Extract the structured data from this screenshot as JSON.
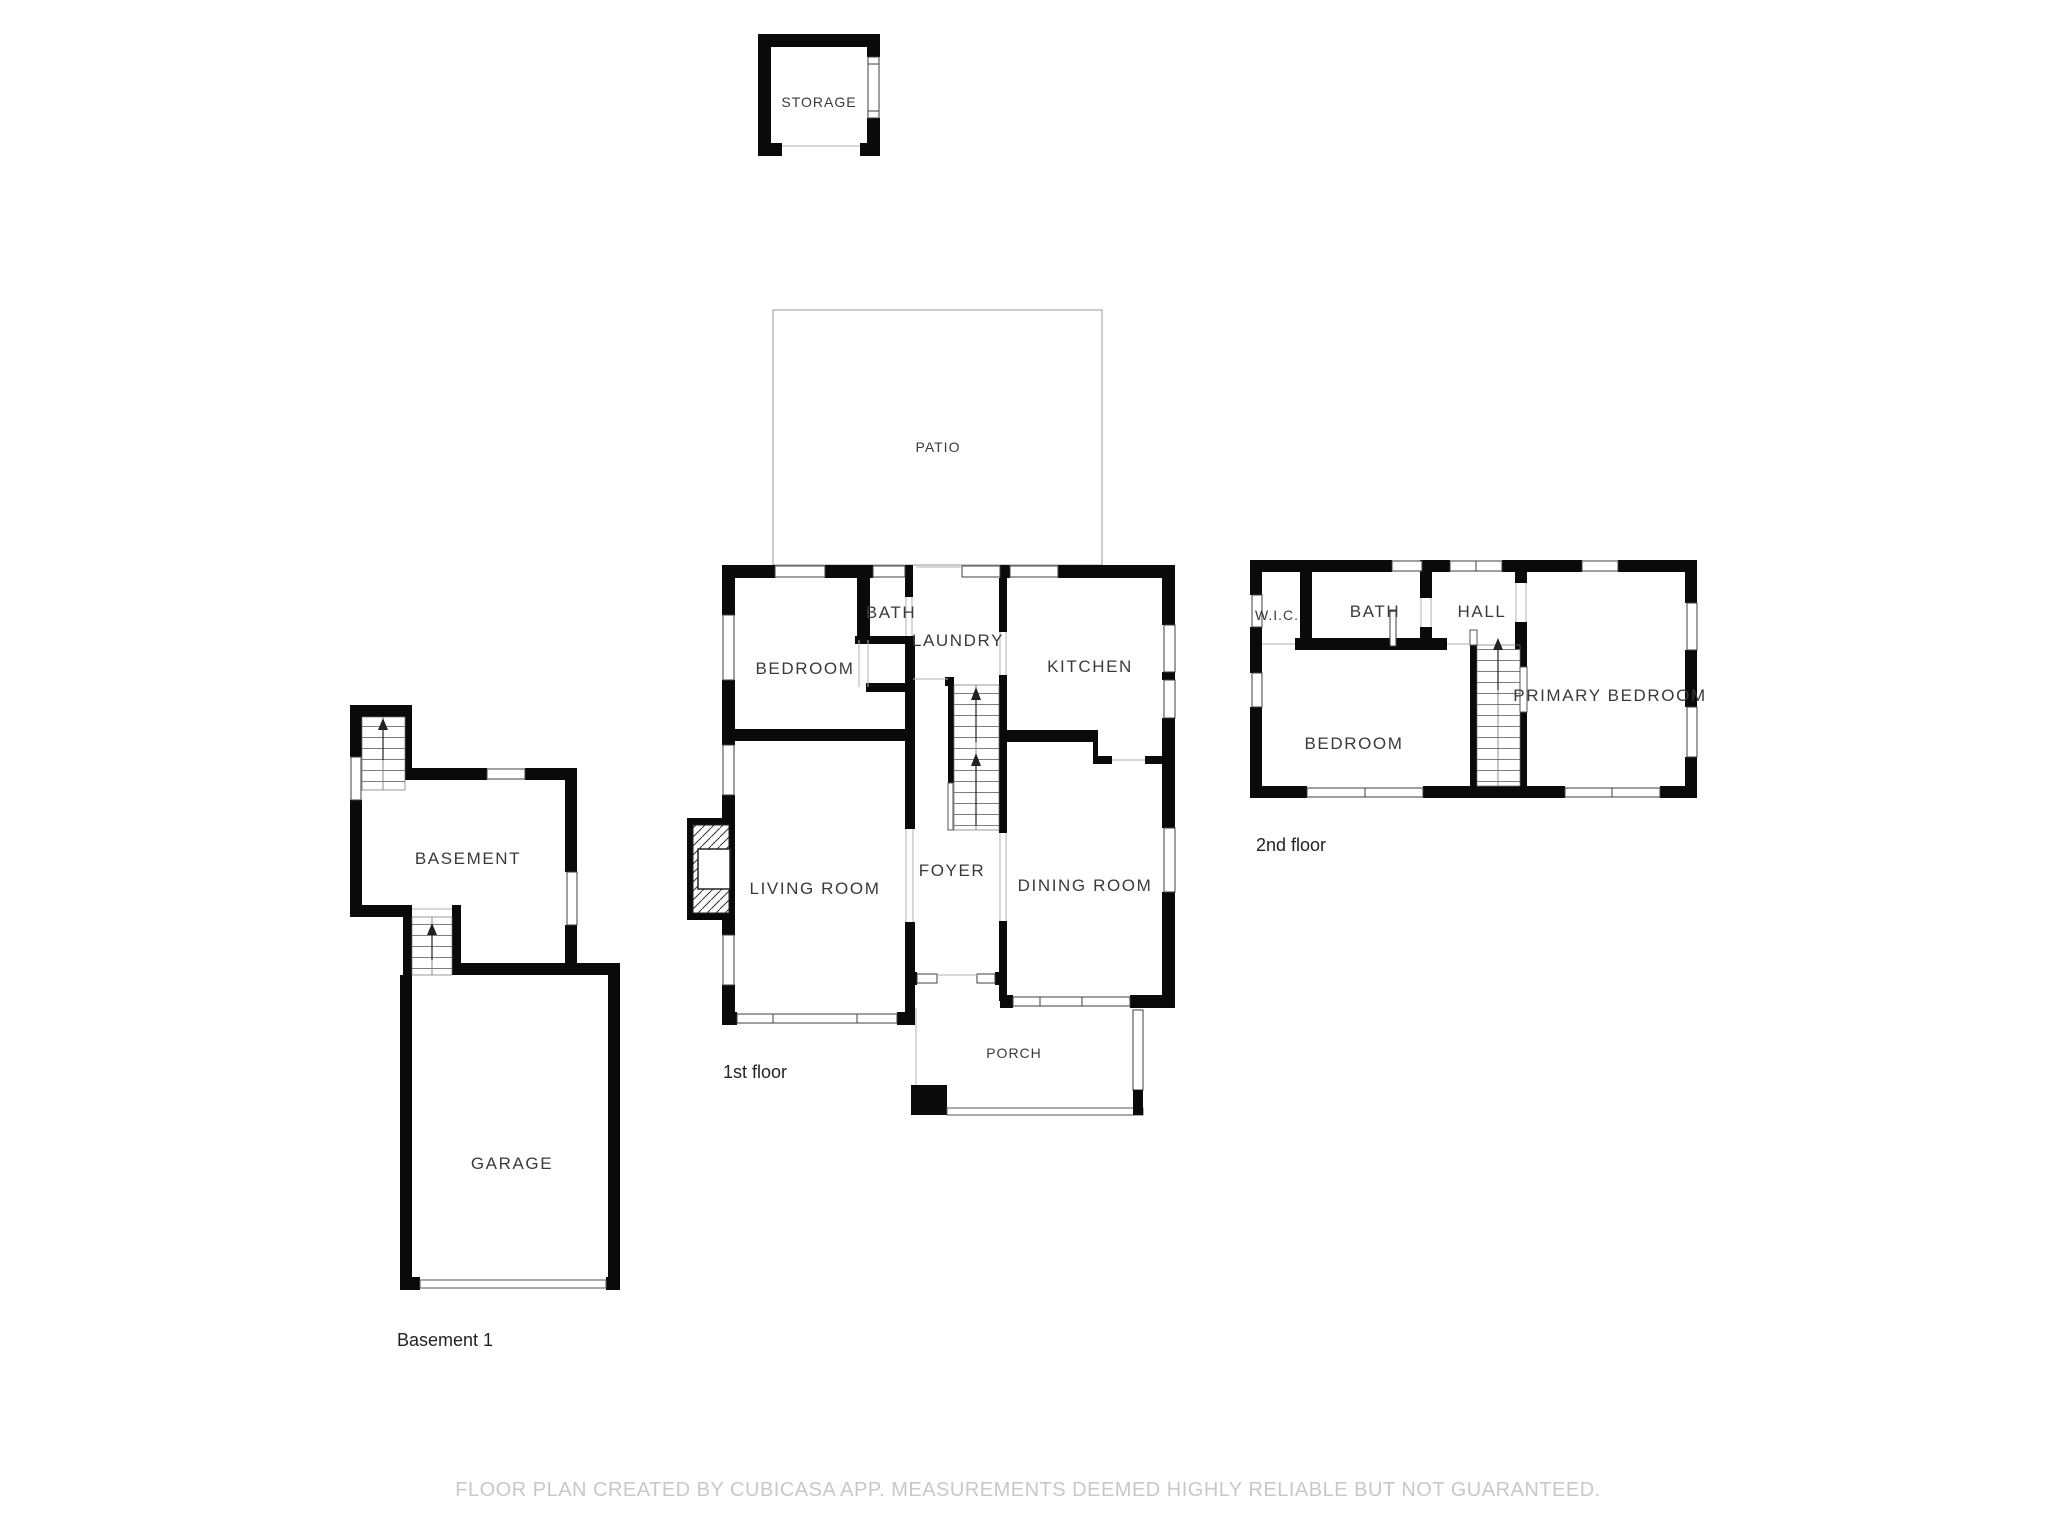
{
  "floors": {
    "storage": {
      "label": "STORAGE"
    },
    "patio": {
      "label": "PATIO"
    },
    "first": {
      "name": "1st floor",
      "rooms": {
        "bedroom": "BEDROOM",
        "bath": "BATH",
        "laundry": "LAUNDRY",
        "kitchen": "KITCHEN",
        "living": "LIVING ROOM",
        "foyer": "FOYER",
        "dining": "DINING ROOM",
        "porch": "PORCH"
      }
    },
    "second": {
      "name": "2nd floor",
      "rooms": {
        "wic": "W.I.C.",
        "bath": "BATH",
        "hall": "HALL",
        "primary": "PRIMARY BEDROOM",
        "bedroom": "BEDROOM"
      }
    },
    "basement": {
      "name": "Basement 1",
      "rooms": {
        "basement": "BASEMENT",
        "garage": "GARAGE"
      }
    }
  },
  "footer": {
    "disclaimer": "FLOOR PLAN CREATED BY CUBICASA APP. MEASUREMENTS DEEMED HIGHLY RELIABLE BUT NOT GUARANTEED."
  },
  "colors": {
    "wall": "#0a0a0a",
    "thin_line": "#9a9a9a",
    "label": "#3a3a3a",
    "disclaimer": "#c8c8c8",
    "background": "#ffffff"
  }
}
